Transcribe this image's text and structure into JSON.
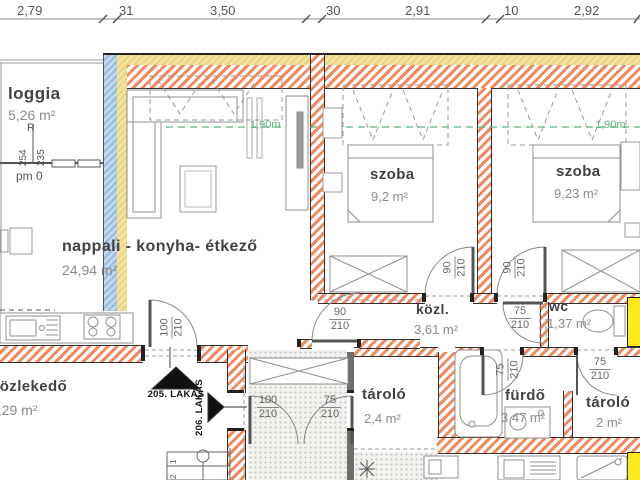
{
  "dimensions": {
    "top": [
      "2,79",
      "31",
      "3,50",
      "30",
      "2,91",
      "10",
      "2,92"
    ]
  },
  "rooms": {
    "loggia": {
      "name": "loggia",
      "area": "5,26 m²"
    },
    "nappali": {
      "name": "nappali - konyha- étkező",
      "area": "24,94 m²"
    },
    "szoba1": {
      "name": "szoba",
      "area": "9,2 m²"
    },
    "szoba2": {
      "name": "szoba",
      "area": "9,23 m²"
    },
    "kozl": {
      "name": "közl.",
      "area": "3,61 m²"
    },
    "wc": {
      "name": "wc",
      "area": "1,37 m²"
    },
    "furdo": {
      "name": "fürdő",
      "area": "3,47 m²"
    },
    "tarolo1": {
      "name": "tároló",
      "area": "2,4 m²"
    },
    "tarolo2": {
      "name": "tároló",
      "area": "2 m²"
    },
    "kozlekedo": {
      "name": "közlekedő",
      "area": "6,29 m²"
    }
  },
  "doors": {
    "entry205": {
      "w": "100",
      "h": "210"
    },
    "vest_left": {
      "w": "100",
      "h": "210"
    },
    "vest_right": {
      "w": "75",
      "h": "210"
    },
    "nappali_kozl": {
      "w": "90",
      "h": "210"
    },
    "szoba1": {
      "w": "90",
      "h": "210"
    },
    "szoba2": {
      "w": "90",
      "h": "210"
    },
    "wc": {
      "w": "75",
      "h": "210"
    },
    "furdo": {
      "w": "75",
      "h": "210"
    },
    "tarolo2": {
      "w": "75",
      "h": "210"
    }
  },
  "markers": {
    "apt205": "205. LAKÁS",
    "apt206": "206. LAKÁS",
    "level_r": "R",
    "level_254": "254",
    "level_235": "235",
    "level_pm": "pm 0",
    "height1": "1,90m",
    "height2": "1,90m",
    "stair1": "1",
    "stair2": "2"
  },
  "colors": {
    "wall_hatch": "#ef8a5e",
    "insulation": "#eedd8e",
    "glazing": "#a9c6e3",
    "highlight": "#ffe81a",
    "height_line": "#57b87b",
    "arrow": "#111111"
  }
}
